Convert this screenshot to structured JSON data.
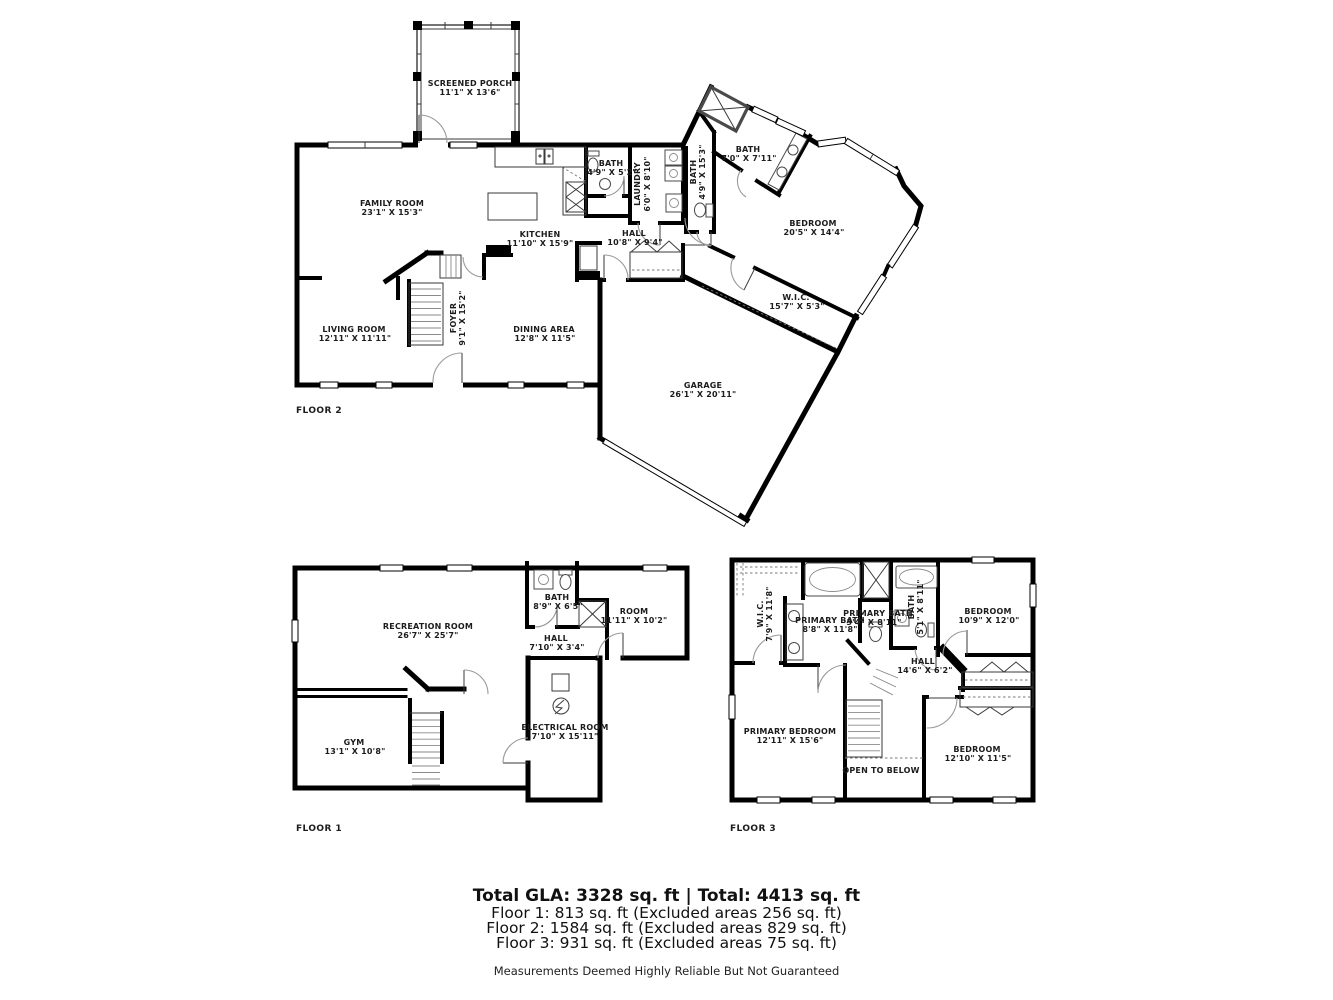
{
  "floor2": {
    "label": "FLOOR 2",
    "rooms": {
      "screened_porch": {
        "name": "SCREENED PORCH",
        "dims": "11'1\" X 13'6\""
      },
      "family_room": {
        "name": "FAMILY ROOM",
        "dims": "23'1\" X 15'3\""
      },
      "kitchen": {
        "name": "KITCHEN",
        "dims": "11'10\" X 15'9\""
      },
      "bath_small": {
        "name": "BATH",
        "dims": "4'9\" X 5'2\""
      },
      "laundry": {
        "name": "LAUNDRY",
        "dims": "6'0\" X 8'10\""
      },
      "bath_strip": {
        "name": "BATH",
        "dims": "4'9\" X 15'3\""
      },
      "hall": {
        "name": "HALL",
        "dims": "10'8\" X 9'4\""
      },
      "bath_upper": {
        "name": "BATH",
        "dims": "7'0\" X 7'11\""
      },
      "bedroom": {
        "name": "BEDROOM",
        "dims": "20'5\" X 14'4\""
      },
      "wic": {
        "name": "W.I.C.",
        "dims": "15'7\" X 5'3\""
      },
      "living_room": {
        "name": "LIVING ROOM",
        "dims": "12'11\" X 11'11\""
      },
      "foyer": {
        "name": "FOYER",
        "dims": "9'1\" X 15'2\""
      },
      "dining_area": {
        "name": "DINING AREA",
        "dims": "12'8\" X 11'5\""
      },
      "garage": {
        "name": "GARAGE",
        "dims": "26'1\" X 20'11\""
      }
    }
  },
  "floor1": {
    "label": "FLOOR 1",
    "rooms": {
      "recreation_room": {
        "name": "RECREATION ROOM",
        "dims": "26'7\" X 25'7\""
      },
      "bath": {
        "name": "BATH",
        "dims": "8'9\" X 6'5\""
      },
      "room": {
        "name": "ROOM",
        "dims": "11'11\" X 10'2\""
      },
      "hall": {
        "name": "HALL",
        "dims": "7'10\" X 3'4\""
      },
      "gym": {
        "name": "GYM",
        "dims": "13'1\" X 10'8\""
      },
      "electrical_room": {
        "name": "ELECTRICAL ROOM",
        "dims": "7'10\" X 15'11\""
      }
    }
  },
  "floor3": {
    "label": "FLOOR 3",
    "rooms": {
      "wic": {
        "name": "W.I.C.",
        "dims": "7'9\" X 11'8\""
      },
      "primary_bath": {
        "name": "PRIMARY BATH",
        "dims": "8'8\" X 11'8\""
      },
      "primary_bath_2": {
        "name": "PRIMARY BATH",
        "dims": "3'4\" X 8'11\""
      },
      "bath": {
        "name": "BATH",
        "dims": "5'1\" X 8'11\""
      },
      "bedroom_ne": {
        "name": "BEDROOM",
        "dims": "10'9\" X 12'0\""
      },
      "hall": {
        "name": "HALL",
        "dims": "14'6\" X 6'2\""
      },
      "primary_bedroom": {
        "name": "PRIMARY BEDROOM",
        "dims": "12'11\" X 15'6\""
      },
      "open_to_below": {
        "name": "OPEN TO BELOW",
        "dims": ""
      },
      "bedroom_se": {
        "name": "BEDROOM",
        "dims": "12'10\" X 11'5\""
      }
    }
  },
  "summary": {
    "total_line": "Total GLA: 3328 sq. ft | Total: 4413 sq. ft",
    "floor1_line": "Floor 1: 813 sq. ft (Excluded areas 256 sq. ft)",
    "floor2_line": "Floor 2: 1584 sq. ft (Excluded areas 829 sq. ft)",
    "floor3_line": "Floor 3: 931 sq. ft (Excluded areas 75 sq. ft)",
    "disclaimer": "Measurements Deemed Highly Reliable But Not Guaranteed"
  }
}
